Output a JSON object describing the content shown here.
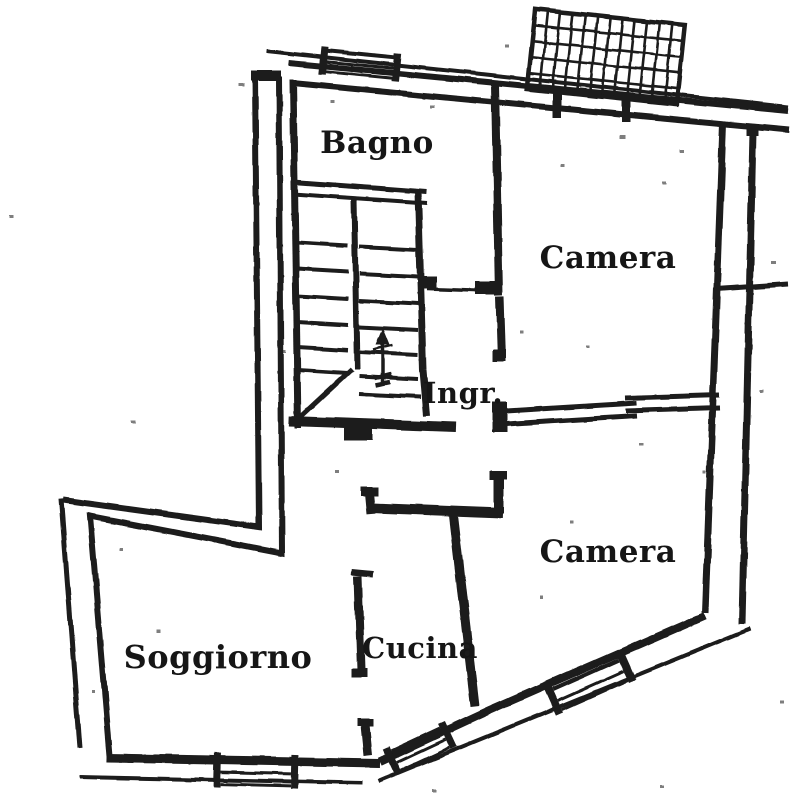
{
  "plan": {
    "kind_note": "scanned apartment floor plan",
    "rooms": [
      {
        "id": "bagno",
        "label": "Bagno"
      },
      {
        "id": "camera-nord",
        "label": "Camera"
      },
      {
        "id": "ingresso",
        "label": "Ingr."
      },
      {
        "id": "camera-sud",
        "label": "Camera"
      },
      {
        "id": "cucina",
        "label": "Cucina"
      },
      {
        "id": "soggiorno",
        "label": "Soggiorno"
      }
    ],
    "colors": {
      "ink": "#1b1b1b",
      "paper": "#ffffff"
    }
  }
}
